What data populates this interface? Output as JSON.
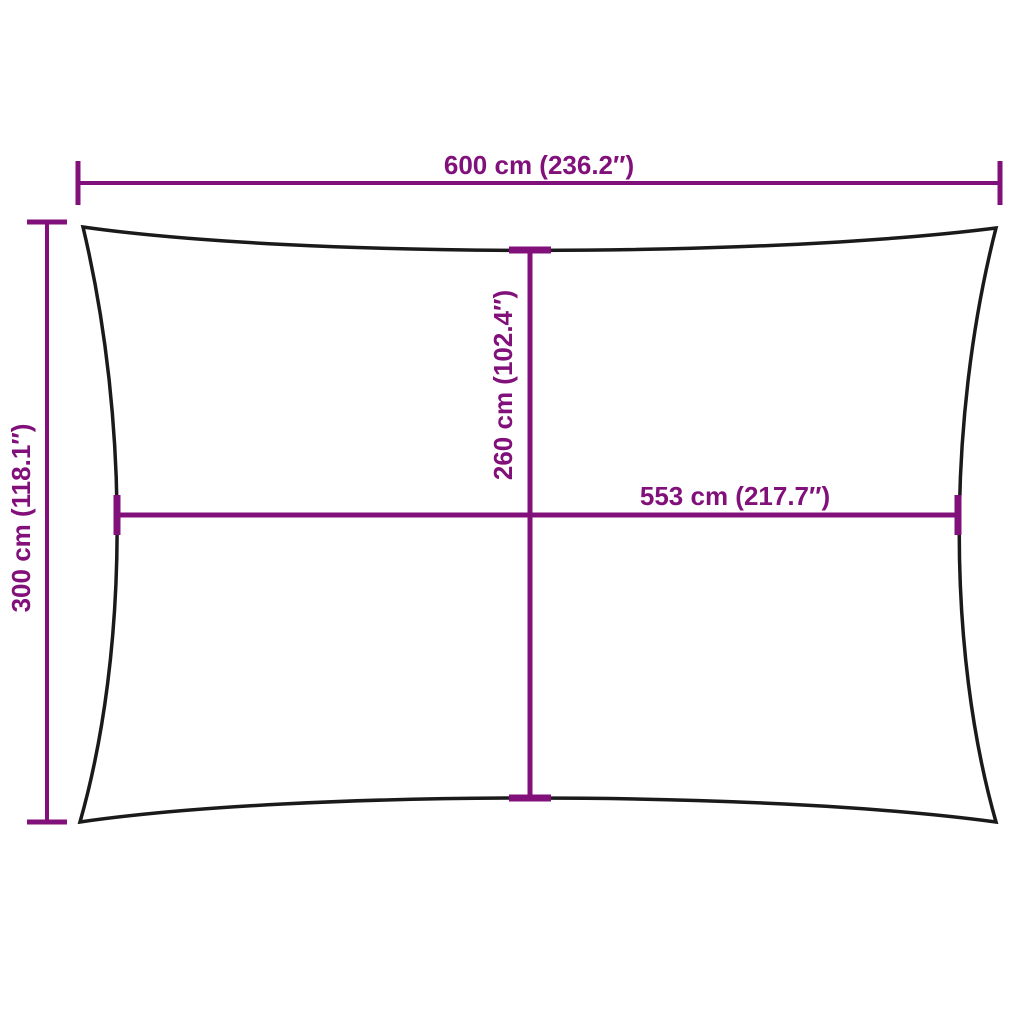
{
  "diagram": {
    "labels": {
      "top_width": "600 cm (236.2″)",
      "left_height": "300 cm (118.1″)",
      "middle_height": "260 cm (102.4″)",
      "middle_width": "553 cm (217.7″)"
    }
  },
  "colors": {
    "dimension": "#82107A",
    "outline": "#1a1a1a",
    "background": "#ffffff"
  }
}
